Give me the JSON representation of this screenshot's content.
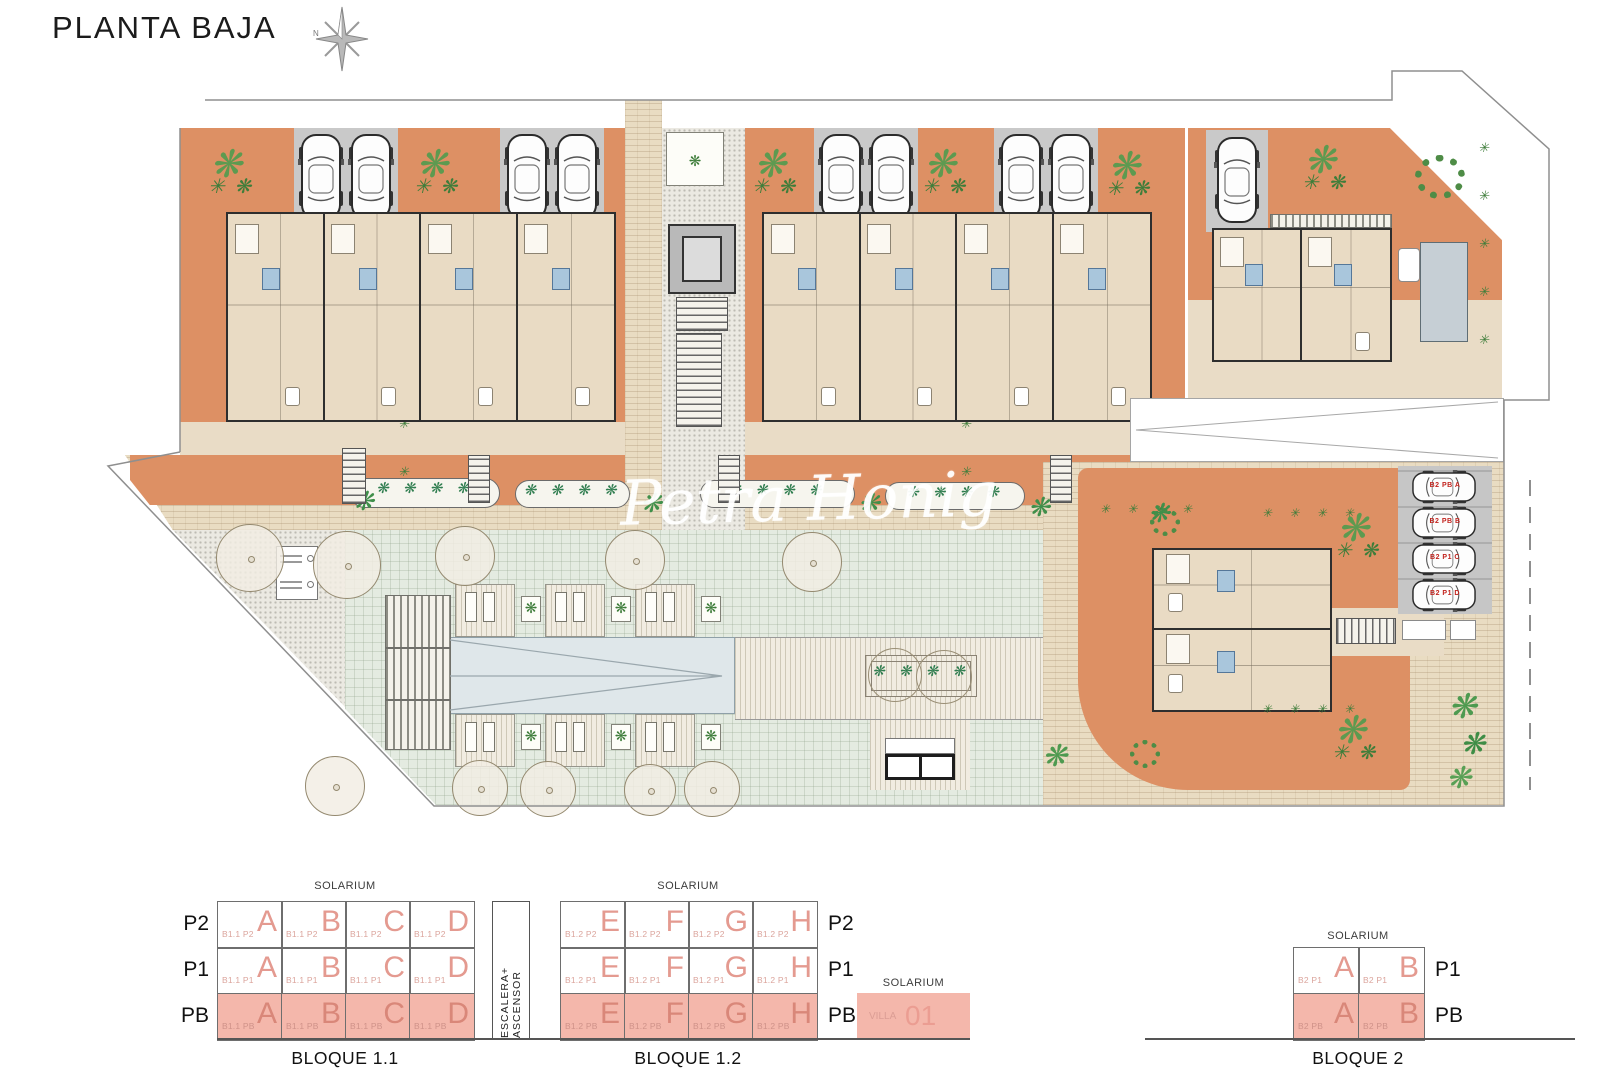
{
  "title": "PLANTA BAJA",
  "watermark": "Petra Honig",
  "compass": {
    "north_label": "N"
  },
  "legend": {
    "escalera_label": "ESCALERA+ ASCENSOR",
    "villa": {
      "solarium": "SOLARIUM",
      "prefix": "VILLA",
      "number": "01"
    },
    "blocks": [
      {
        "id": "bloque-1-1",
        "label": "BLOQUE 1.1",
        "solarium": "SOLARIUM",
        "row_label_side": "left",
        "rows": [
          {
            "label": "P2",
            "highlight": false,
            "cells": [
              {
                "prefix": "B1.1 P2",
                "unit": "A"
              },
              {
                "prefix": "B1.1 P2",
                "unit": "B"
              },
              {
                "prefix": "B1.1 P2",
                "unit": "C"
              },
              {
                "prefix": "B1.1 P2",
                "unit": "D"
              }
            ]
          },
          {
            "label": "P1",
            "highlight": false,
            "cells": [
              {
                "prefix": "B1.1 P1",
                "unit": "A"
              },
              {
                "prefix": "B1.1 P1",
                "unit": "B"
              },
              {
                "prefix": "B1.1 P1",
                "unit": "C"
              },
              {
                "prefix": "B1.1 P1",
                "unit": "D"
              }
            ]
          },
          {
            "label": "PB",
            "highlight": true,
            "cells": [
              {
                "prefix": "B1.1 PB",
                "unit": "A"
              },
              {
                "prefix": "B1.1 PB",
                "unit": "B"
              },
              {
                "prefix": "B1.1 PB",
                "unit": "C"
              },
              {
                "prefix": "B1.1 PB",
                "unit": "D"
              }
            ]
          }
        ]
      },
      {
        "id": "bloque-1-2",
        "label": "BLOQUE 1.2",
        "solarium": "SOLARIUM",
        "row_label_side": "right",
        "rows": [
          {
            "label": "P2",
            "highlight": false,
            "cells": [
              {
                "prefix": "B1.2 P2",
                "unit": "E"
              },
              {
                "prefix": "B1.2 P2",
                "unit": "F"
              },
              {
                "prefix": "B1.2 P2",
                "unit": "G"
              },
              {
                "prefix": "B1.2 P2",
                "unit": "H"
              }
            ]
          },
          {
            "label": "P1",
            "highlight": false,
            "cells": [
              {
                "prefix": "B1.2 P1",
                "unit": "E"
              },
              {
                "prefix": "B1.2 P1",
                "unit": "F"
              },
              {
                "prefix": "B1.2 P1",
                "unit": "G"
              },
              {
                "prefix": "B1.2 P1",
                "unit": "H"
              }
            ]
          },
          {
            "label": "PB",
            "highlight": true,
            "cells": [
              {
                "prefix": "B1.2 PB",
                "unit": "E"
              },
              {
                "prefix": "B1.2 PB",
                "unit": "F"
              },
              {
                "prefix": "B1.2 PB",
                "unit": "G"
              },
              {
                "prefix": "B1.2 PB",
                "unit": "H"
              }
            ]
          }
        ]
      },
      {
        "id": "bloque-2",
        "label": "BLOQUE 2",
        "solarium": "SOLARIUM",
        "row_label_side": "right",
        "rows": [
          {
            "label": "P1",
            "highlight": false,
            "cells": [
              {
                "prefix": "B2 P1",
                "unit": "A"
              },
              {
                "prefix": "B2 P1",
                "unit": "B"
              }
            ]
          },
          {
            "label": "PB",
            "highlight": true,
            "cells": [
              {
                "prefix": "B2 PB",
                "unit": "A"
              },
              {
                "prefix": "B2 PB",
                "unit": "B"
              }
            ]
          }
        ]
      }
    ]
  },
  "plan": {
    "parking_cars": [
      "B2 PB A",
      "B2 PB B",
      "B2 P1 C",
      "B2 P1 D"
    ]
  },
  "colors": {
    "terracotta": "#dd9064",
    "highlight_fill": "#f4b7ab",
    "unit_letter": "#e49a90",
    "parking_gray": "#c9c9c9",
    "lawn": "#e4ebe1",
    "pool": "#dfe7ea",
    "car_label_red": "#c2231d"
  }
}
